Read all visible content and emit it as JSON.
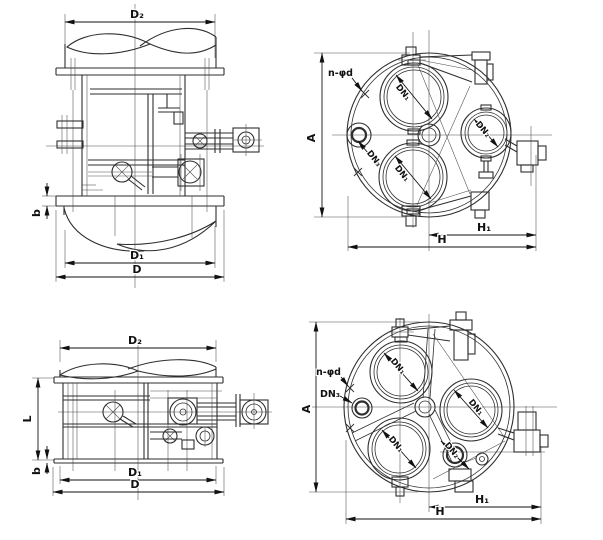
{
  "colors": {
    "ink": "#2e2e2e",
    "dim": "#111111",
    "background": "#ffffff"
  },
  "views": {
    "top_side": {
      "d2": "D₂",
      "b": "b",
      "d1": "D₁",
      "d": "D"
    },
    "top_plan": {
      "n_phi_d": "n-φd",
      "a": "A",
      "dn1_upper": "DN₁",
      "dn1_lower": "DN₁",
      "dn2": "DN₂",
      "dn3": "DN₃",
      "h1": "H₁",
      "h": "H"
    },
    "bottom_side": {
      "d2": "D₂",
      "l": "L",
      "b": "b",
      "d1": "D₁",
      "d": "D"
    },
    "bottom_plan": {
      "n_phi_d": "n-φd",
      "dn3": "DN₃",
      "a": "A",
      "dn1_top_left": "DN₁",
      "dn1_right": "DN₁",
      "dn1_bottom_left": "DN₁",
      "dn2": "DN₂",
      "h1": "H₁",
      "h": "H"
    }
  }
}
